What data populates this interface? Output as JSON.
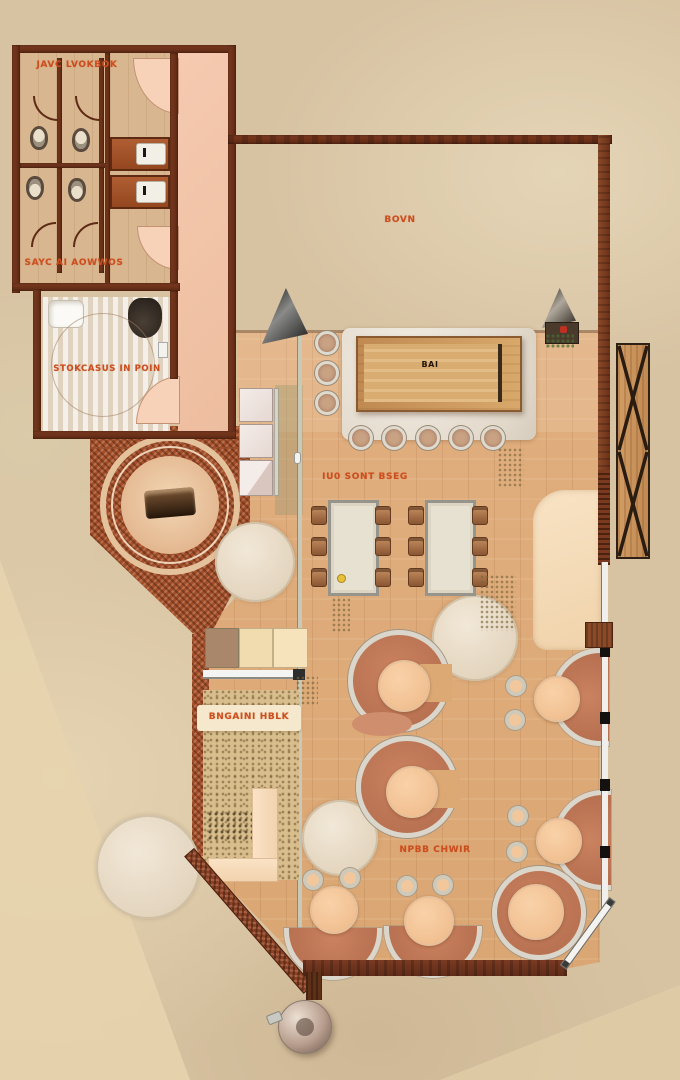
{
  "plan_labels": {
    "restroom_top": "JAVC LVOKBOK",
    "restroom_bottom": "SAYC AI AOWWOS",
    "shower_room": "STOKCASUS IN POIN",
    "terrace": "BOVN",
    "bar": "BAI",
    "dining": "IU0 SONT BSEG",
    "garden": "BNGAINI HBLK",
    "booth_area": "NPBB CHWIR"
  },
  "colors": {
    "label_orange": "#cc4d1d",
    "wall_brown": "#6b3018",
    "wood_floor": "#dca873",
    "terracotta_booth": "#bf7354",
    "peach_table": "#f5c79e",
    "background_stone": "#d7c3a2",
    "pink_vestibule": "#f2c4a9",
    "cream_bench": "#f5ddbd",
    "glass_partition": "#c9c9ba"
  }
}
